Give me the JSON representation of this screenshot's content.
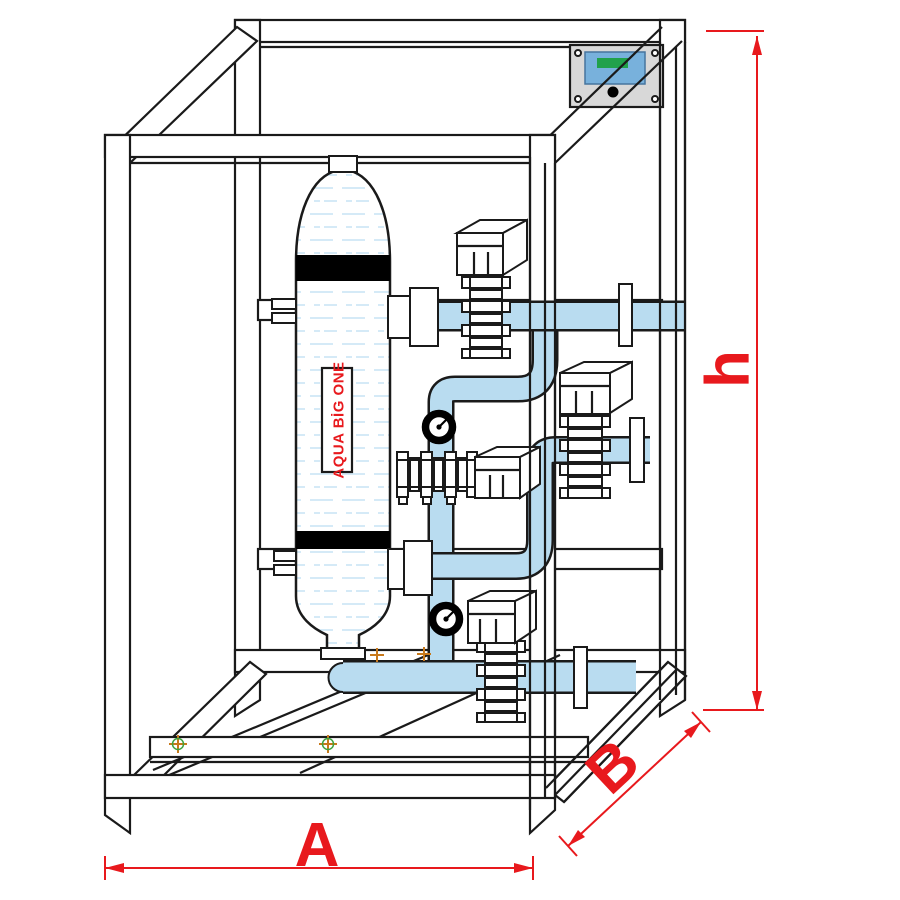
{
  "diagram": {
    "tank": {
      "label": "AQUA BİG ONE"
    },
    "dimensions": {
      "width_label": "A",
      "depth_label": "B",
      "height_label": "h"
    },
    "colors": {
      "dimension_red": "#e8191d",
      "tank_label_red": "#e8191d",
      "pipe_blue": "#b9dcf0",
      "water_line_blue": "#cfe8f6",
      "panel_gray": "#d8d8d8",
      "panel_screen_blue": "#78b1dc",
      "panel_screen_green": "#21a14b",
      "frame_line": "#1a1a1a",
      "bolt_marker_orange": "#c8791b",
      "bolt_ring_green": "#3fa33f"
    },
    "components": [
      {
        "name": "support-frame",
        "count": 1
      },
      {
        "name": "filter-tank",
        "count": 1
      },
      {
        "name": "actuated-valve",
        "count": 4
      },
      {
        "name": "pressure-gauge",
        "count": 2
      },
      {
        "name": "control-panel",
        "count": 1
      },
      {
        "name": "pipework",
        "count": 1
      },
      {
        "name": "pipe-flange",
        "count": 3
      }
    ]
  }
}
